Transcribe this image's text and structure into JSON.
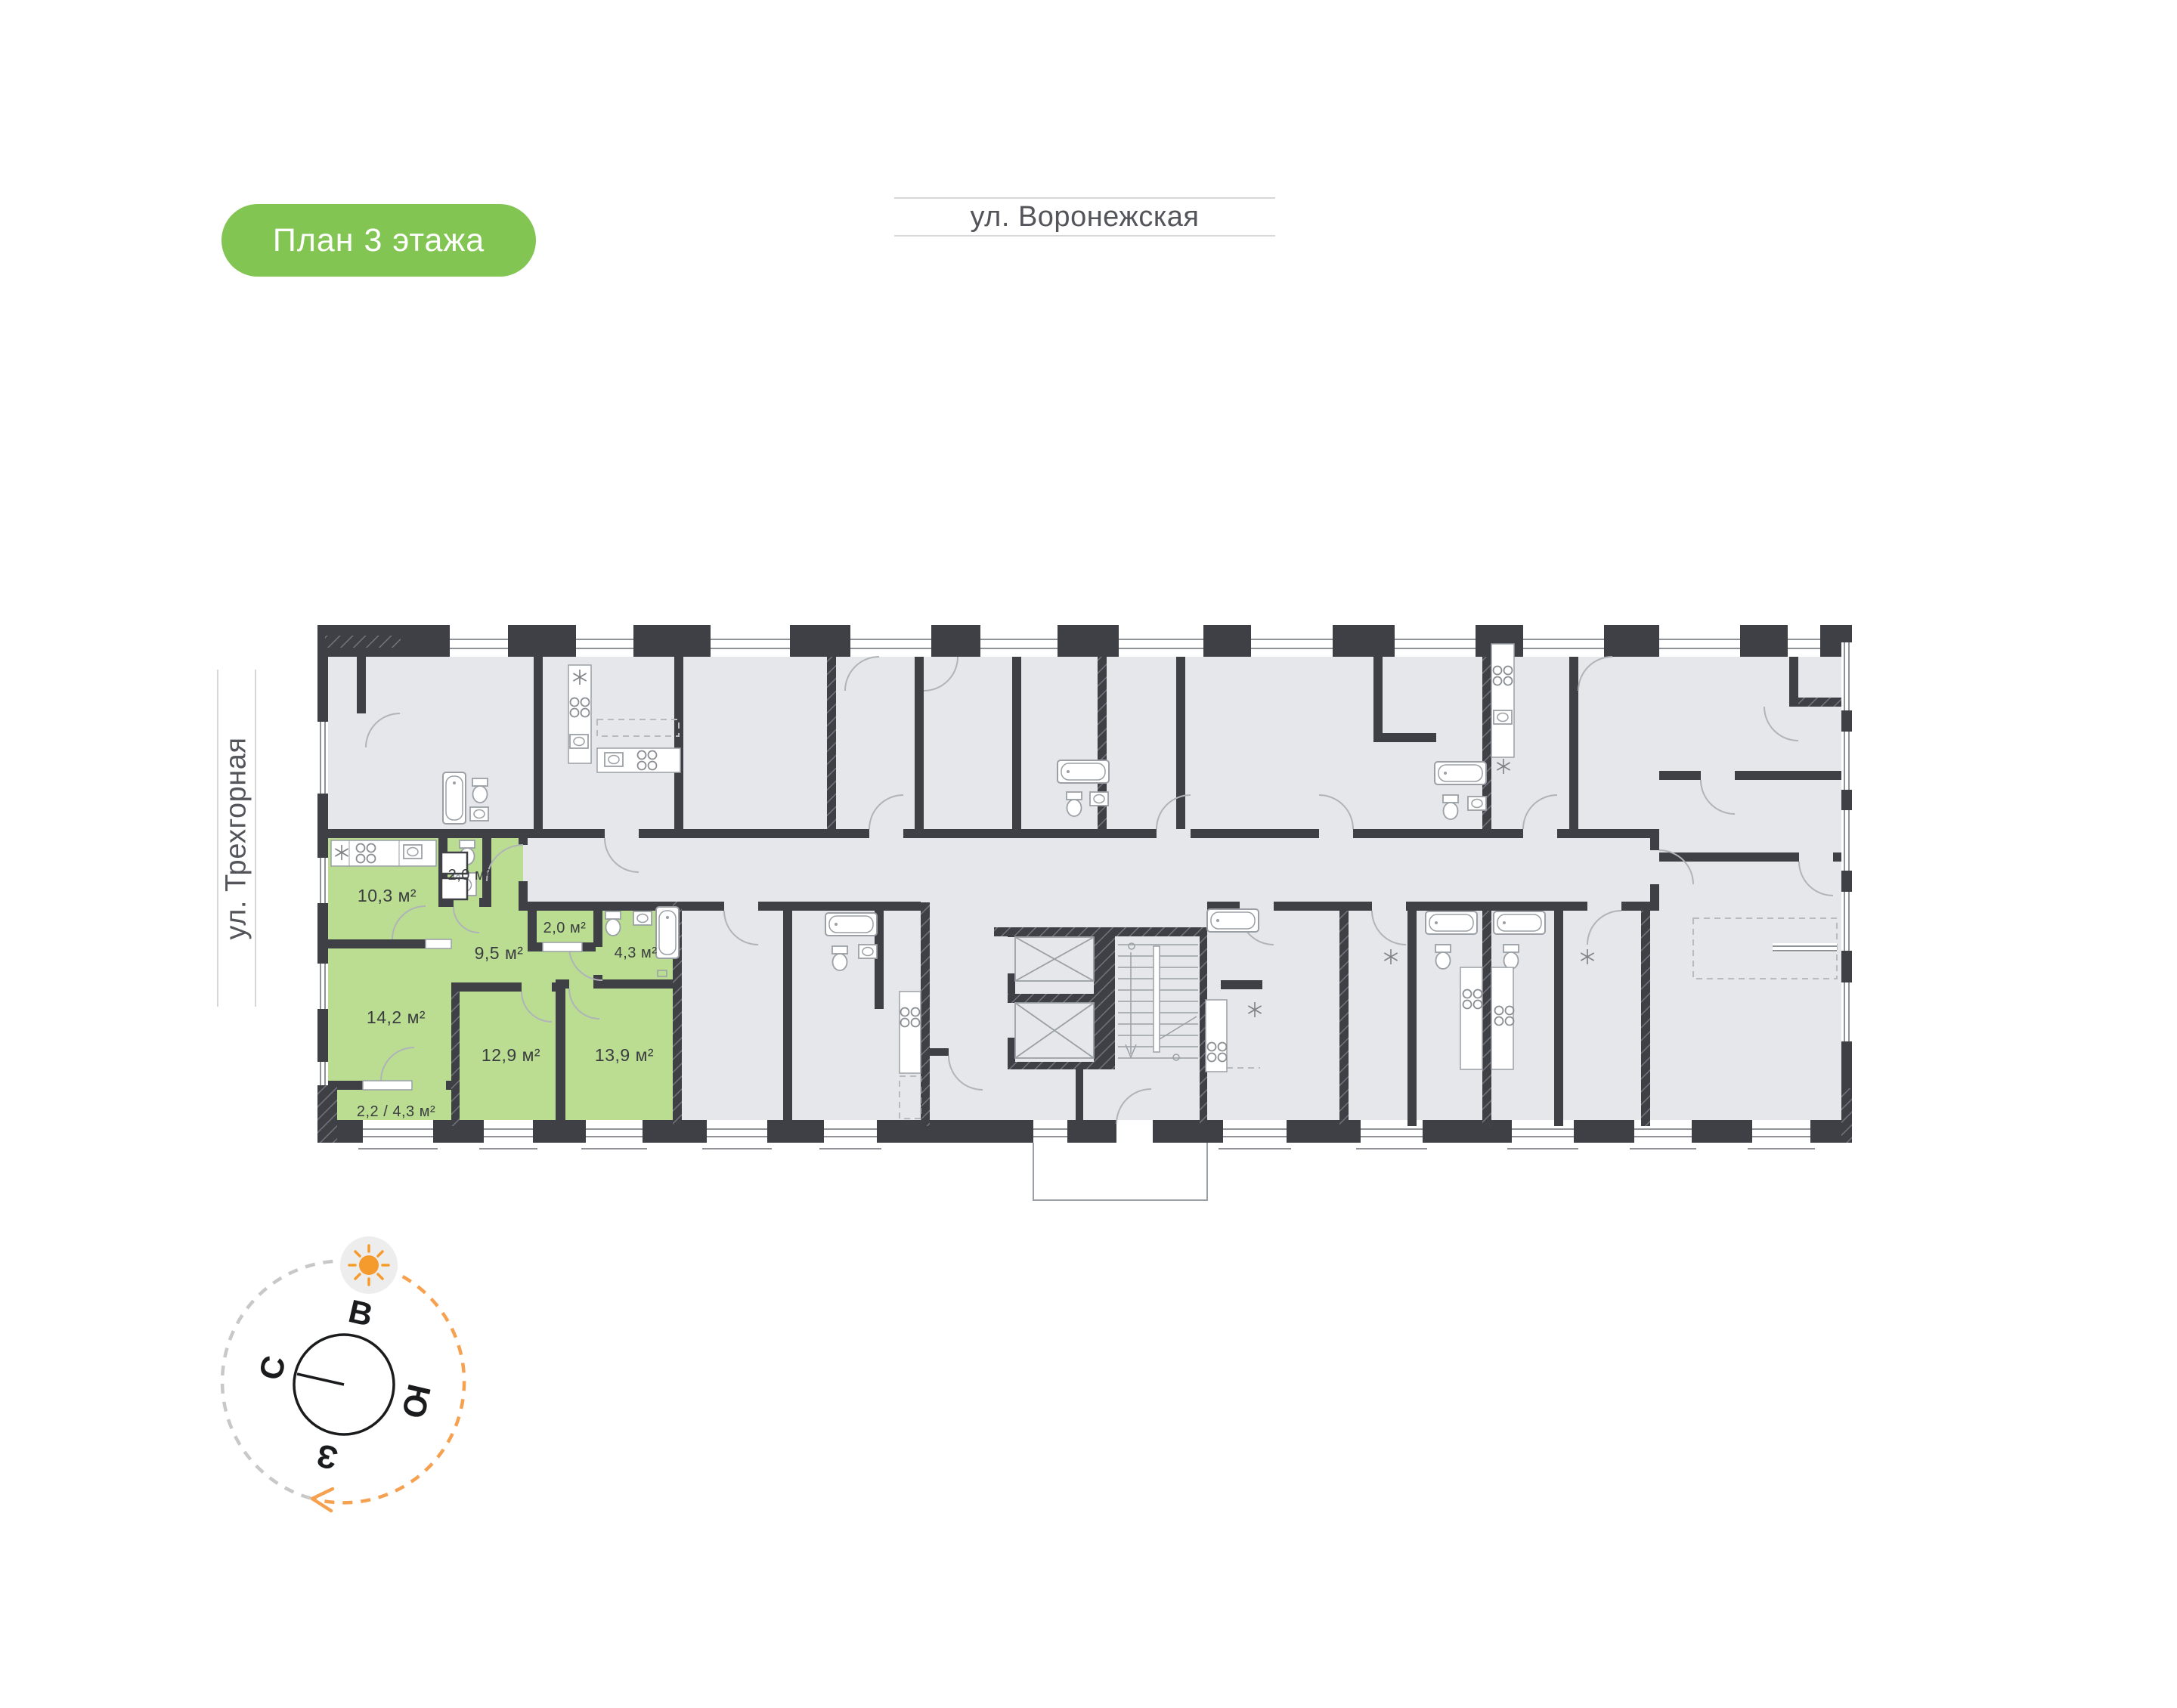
{
  "badge": {
    "label": "План 3 этажа"
  },
  "streets": {
    "top": "ул. Воронежская",
    "left": "ул. Трехгорная"
  },
  "apartment": {
    "rooms": [
      {
        "name": "kitchen",
        "area_label": "10,3 м²"
      },
      {
        "name": "wc",
        "area_label": "2,0 м²"
      },
      {
        "name": "hallway",
        "area_label": "9,5 м²"
      },
      {
        "name": "storage",
        "area_label": "2,0 м²"
      },
      {
        "name": "bathroom",
        "area_label": "4,3 м²"
      },
      {
        "name": "living-room",
        "area_label": "14,2 м²"
      },
      {
        "name": "bedroom-1",
        "area_label": "12,9 м²"
      },
      {
        "name": "bedroom-2",
        "area_label": "13,9 м²"
      },
      {
        "name": "balcony",
        "area_label": "2,2 / 4,3 м²"
      }
    ]
  },
  "compass": {
    "north": "С",
    "east": "В",
    "south": "Ю",
    "west": "З"
  },
  "colors": {
    "badge_green": "#83c553",
    "apartment_green": "#badd92",
    "wall_dark": "#3f4046",
    "unit_gray": "#e5e7ea",
    "accent_orange": "#f6a14f"
  }
}
